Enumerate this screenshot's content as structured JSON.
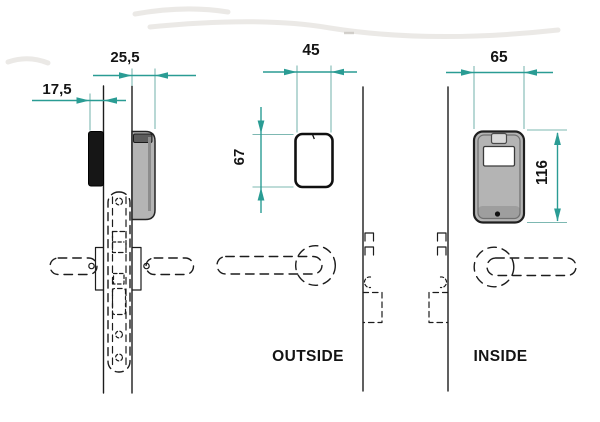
{
  "labels": {
    "outside_view": "OUTSIDE",
    "inside_view": "INSIDE"
  },
  "dimensions": {
    "outside_unit_projection": "17,5",
    "inside_unit_projection": "25,5",
    "outside_unit_width": "45",
    "outside_unit_height": "67",
    "inside_unit_width": "65",
    "inside_unit_height": "116"
  },
  "colors": {
    "dimension_line": "#2a9c94",
    "extension_line": "#7db8b2",
    "ink": "#1c1c1c",
    "unit_fill": "#b4b4b4"
  }
}
